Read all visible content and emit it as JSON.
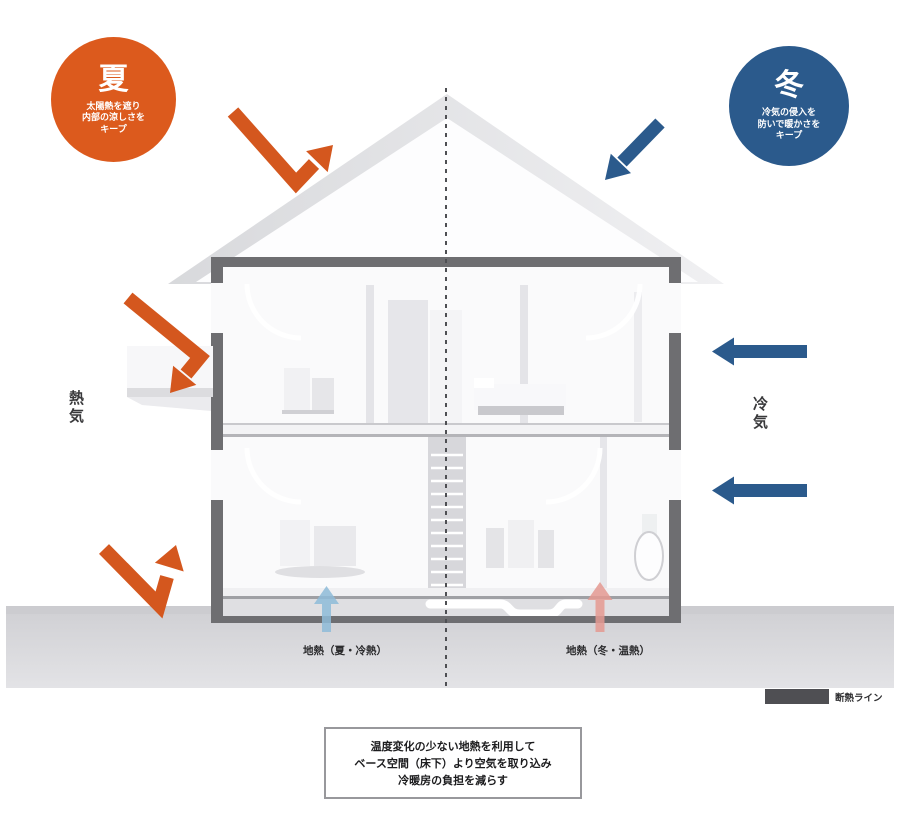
{
  "colors": {
    "summer_orange": "#d4571e",
    "winter_blue": "#2b5a8c",
    "badge_orange": "#dc5a1d",
    "badge_blue": "#2b5a8c",
    "geo_cool": "#8fbcd9",
    "geo_warm": "#e59a92",
    "frame_gray": "#6e6e71",
    "insulation_swatch": "#4f4f53"
  },
  "badges": {
    "summer": {
      "symbol": "夏",
      "lines": [
        "太陽熱を遮り",
        "内部の涼しさを",
        "キープ"
      ]
    },
    "winter": {
      "symbol": "冬",
      "lines": [
        "冷気の侵入を",
        "防いで暖かさを",
        "キープ"
      ]
    }
  },
  "air_labels": {
    "left": "熱気",
    "right": "冷気"
  },
  "ground_labels": {
    "summer": "地熱（夏・冷熱）",
    "winter": "地熱（冬・温熱）"
  },
  "legend": {
    "label": "断熱ライン"
  },
  "caption": {
    "lines": [
      "温度変化の少ない地熱を利用して",
      "ベース空間（床下）より空気を取り込み",
      "冷暖房の負担を減らす"
    ]
  }
}
